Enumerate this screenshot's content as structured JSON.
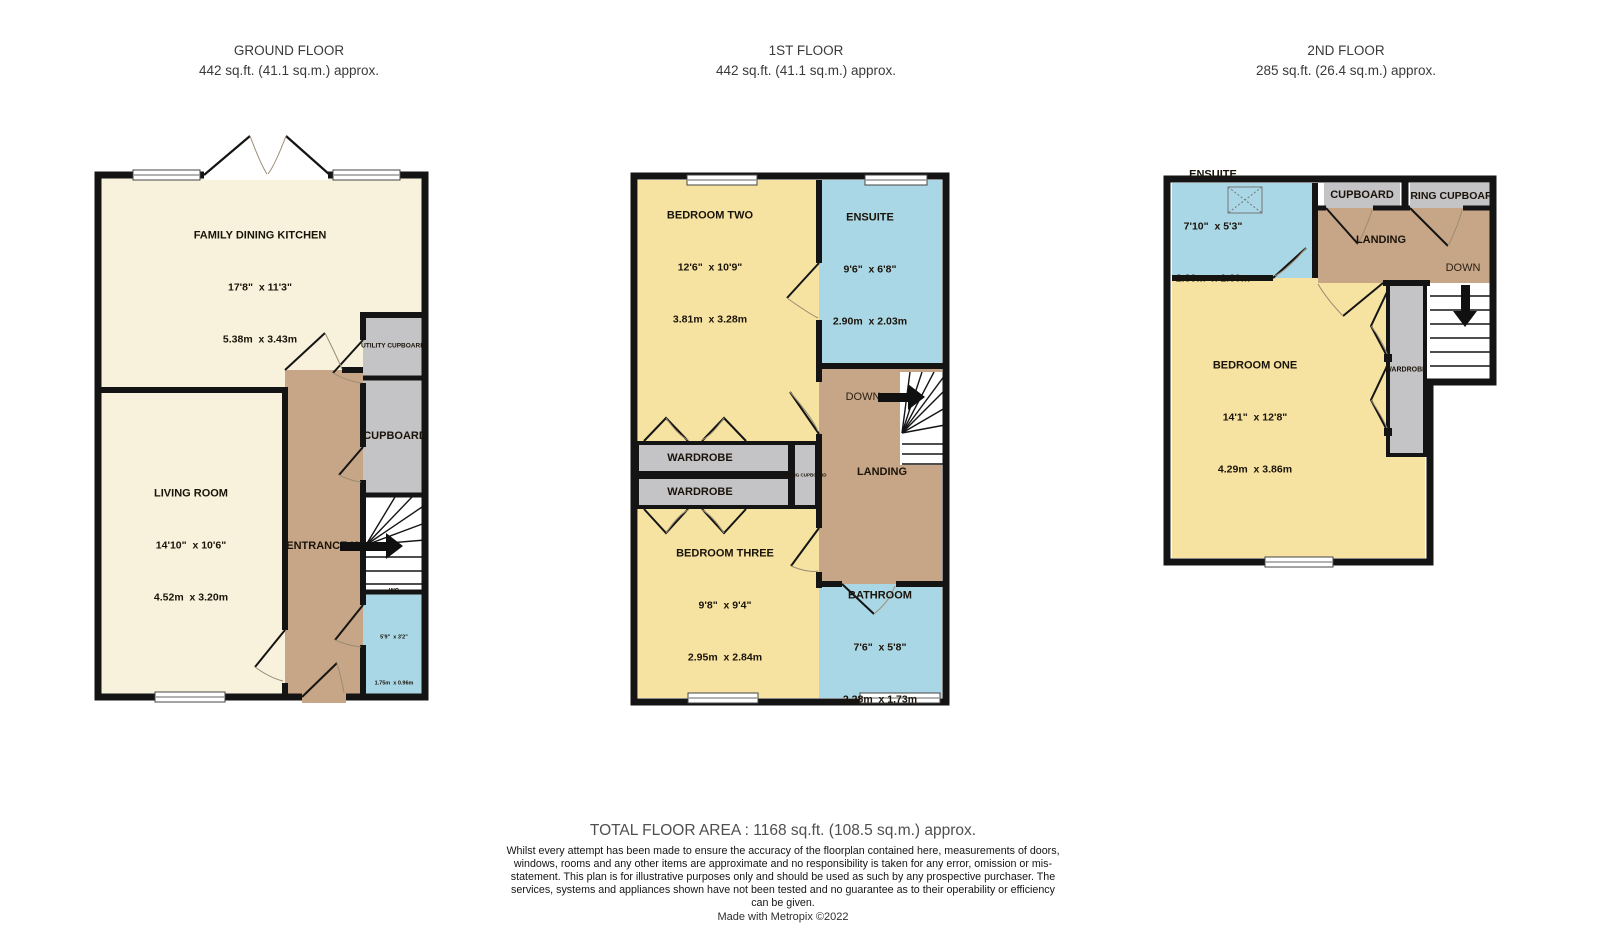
{
  "headers": {
    "ground": {
      "title": "GROUND FLOOR",
      "area": "442 sq.ft. (41.1 sq.m.) approx."
    },
    "first": {
      "title": "1ST FLOOR",
      "area": "442 sq.ft. (41.1 sq.m.) approx."
    },
    "second": {
      "title": "2ND FLOOR",
      "area": "285 sq.ft. (26.4 sq.m.) approx."
    }
  },
  "ground": {
    "kitchen": {
      "name": "FAMILY DINING KITCHEN",
      "imperial": "17'8\"  x 11'3\"",
      "metric": "5.38m  x 3.43m"
    },
    "living": {
      "name": "LIVING ROOM",
      "imperial": "14'10\"  x 10'6\"",
      "metric": "4.52m  x 3.20m"
    },
    "wc": {
      "name": "WC",
      "imperial": "5'9\"  x 3'2\"",
      "metric": "1.75m  x 0.96m"
    },
    "utility_cupboard": "UTILITY CUPBOARD",
    "cupboard": "CUPBOARD",
    "entrance_hall": "ENTRANCE HALL"
  },
  "first": {
    "bedroom_two": {
      "name": "BEDROOM TWO",
      "imperial": "12'6\"  x 10'9\"",
      "metric": "3.81m  x 3.28m"
    },
    "ensuite": {
      "name": "ENSUITE",
      "imperial": "9'6\"  x 6'8\"",
      "metric": "2.90m  x 2.03m"
    },
    "bedroom_three": {
      "name": "BEDROOM THREE",
      "imperial": "9'8\"  x 9'4\"",
      "metric": "2.95m  x 2.84m"
    },
    "bathroom": {
      "name": "BATHROOM",
      "imperial": "7'6\"  x 5'8\"",
      "metric": "2.28m  x 1.73m"
    },
    "wardrobe": "WARDROBE",
    "airing_cupboard": "AIRING CUPBOARD",
    "landing": "LANDING",
    "down": "DOWN"
  },
  "second": {
    "ensuite": {
      "name": "ENSUITE",
      "imperial": "7'10\"  x 5'3\"",
      "metric": "2.39m  x 1.60m"
    },
    "bedroom_one": {
      "name": "BEDROOM ONE",
      "imperial": "14'1\"  x 12'8\"",
      "metric": "4.29m  x 3.86m"
    },
    "cupboard": "CUPBOARD",
    "airing_cupboard": "AIRING CUPBOARD",
    "landing": "LANDING",
    "down": "DOWN",
    "wardrobe": "WARDROBE"
  },
  "footer": {
    "total": "TOTAL FLOOR AREA : 1168 sq.ft. (108.5 sq.m.) approx.",
    "disclaimer": "Whilst every attempt has been made to ensure the accuracy of the floorplan contained here, measurements of doors, windows, rooms and any other items are approximate and no responsibility is taken for any error, omission or mis-statement. This plan is for illustrative purposes only and should be used as such by any prospective purchaser. The services, systems and appliances shown have not been tested and no guarantee as to their operability or efficiency can be given.",
    "credit": "Made with Metropix ©2022"
  }
}
